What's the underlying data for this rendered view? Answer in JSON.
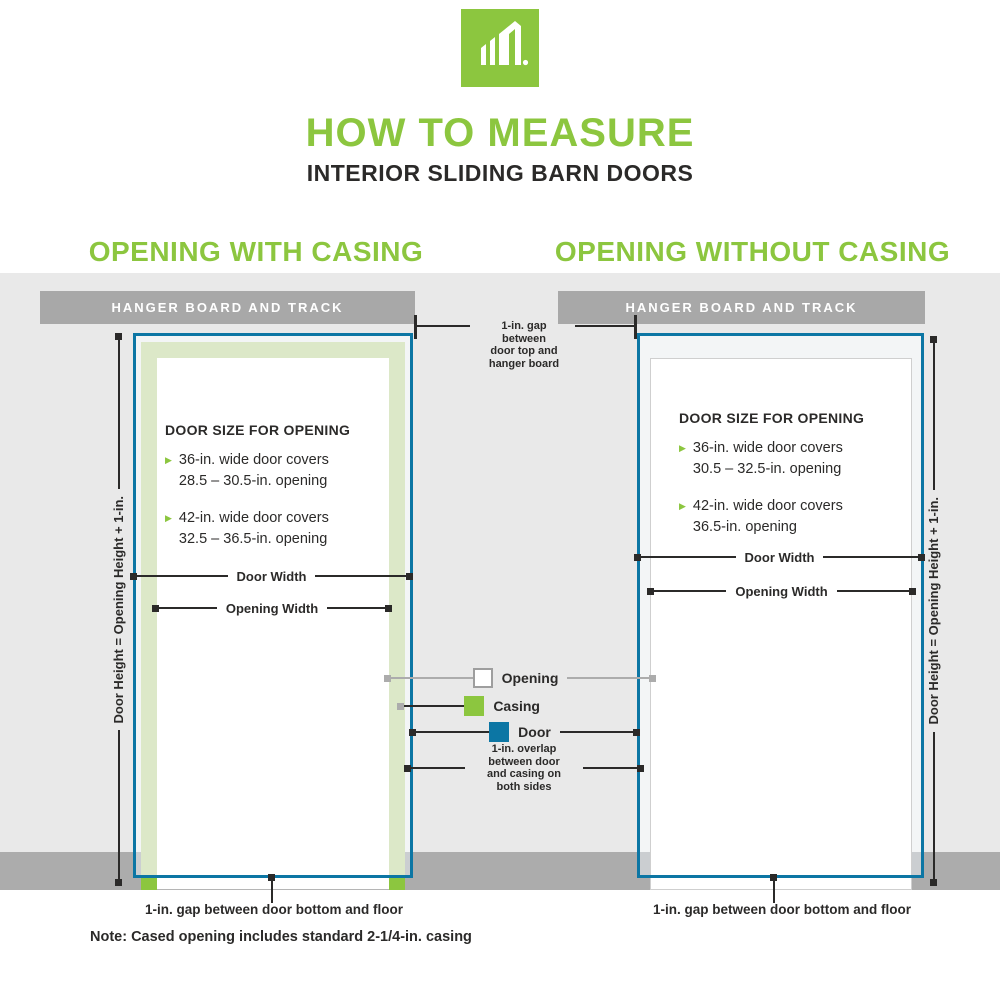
{
  "header": {
    "title": "HOW TO MEASURE",
    "subtitle": "INTERIOR SLIDING BARN DOORS"
  },
  "sections": {
    "left": {
      "title": "OPENING WITH CASING",
      "hanger_label": "HANGER BOARD AND TRACK",
      "door_size_heading": "DOOR SIZE FOR OPENING",
      "bullets": [
        {
          "line1": "36-in. wide door covers",
          "line2": "28.5 – 30.5-in. opening"
        },
        {
          "line1": "42-in. wide door covers",
          "line2": "32.5 – 36.5-in. opening"
        }
      ],
      "door_width_label": "Door Width",
      "opening_width_label": "Opening Width",
      "height_label": "Door Height = Opening Height + 1-in.",
      "floor_gap_label": "1-in. gap between door bottom and floor"
    },
    "right": {
      "title": "OPENING WITHOUT CASING",
      "hanger_label": "HANGER BOARD AND TRACK",
      "door_size_heading": "DOOR SIZE FOR OPENING",
      "bullets": [
        {
          "line1": "36-in. wide door covers",
          "line2": "30.5 – 32.5-in. opening"
        },
        {
          "line1": "42-in. wide door covers",
          "line2": "36.5-in. opening"
        }
      ],
      "door_width_label": "Door Width",
      "opening_width_label": "Opening Width",
      "height_label": "Door Height = Opening Height + 1-in.",
      "floor_gap_label": "1-in. gap between door bottom and floor"
    }
  },
  "annotations": {
    "top_gap": {
      "l1": "1-in. gap",
      "l2": "between",
      "l3": "door top and",
      "l4": "hanger board"
    },
    "overlap": {
      "l1": "1-in. overlap",
      "l2": "between door",
      "l3": "and casing on",
      "l4": "both sides"
    },
    "note": "Note: Cased opening includes standard 2-1/4-in. casing"
  },
  "legend": {
    "items": [
      {
        "label": "Opening",
        "color": "#FFFFFF"
      },
      {
        "label": "Casing",
        "color": "#8CC63F"
      },
      {
        "label": "Door",
        "color": "#0C76A4"
      }
    ]
  },
  "colors": {
    "brand_green": "#8CC63F",
    "door_blue": "#0C76A4",
    "casing_pale": "#DCE8C8",
    "wall_gray": "#E9E9E9",
    "floor_gray": "#ACACAC",
    "hanger_gray": "#A8A8A8",
    "text_dark": "#2B2A29"
  }
}
